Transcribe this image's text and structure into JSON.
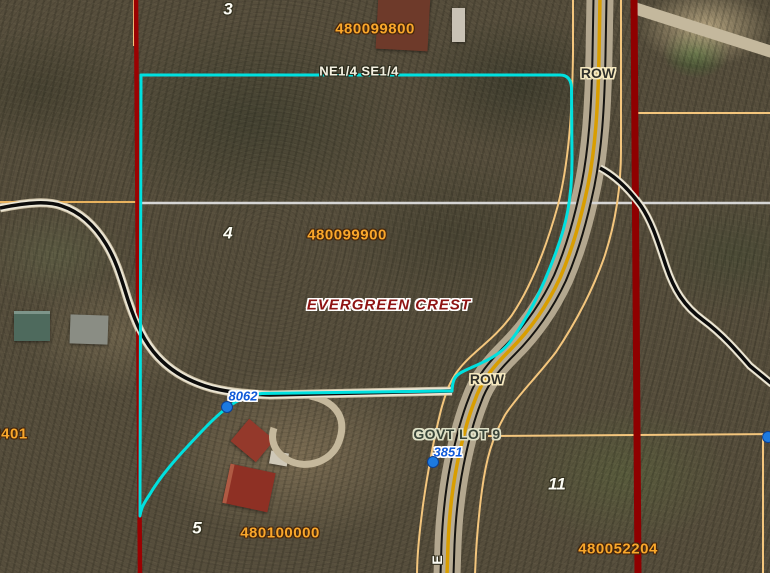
{
  "map": {
    "labels": {
      "section_3": "3",
      "parcel_480099800": "480099800",
      "aliquot_ne_se": "NE1/4 SE1/4",
      "row_upper": "ROW",
      "section_4": "4",
      "parcel_480099900": "480099900",
      "subdivision": "EVERGREEN CREST",
      "address_8062": "8062",
      "row_lower": "ROW",
      "govt_lot": "GOVT LOT 9",
      "address_3851": "3851",
      "section_11": "11",
      "parcel_480052204": "480052204",
      "parcel_480100000": "480100000",
      "section_5": "5",
      "parcel_2401": "2401",
      "road_name_partial": "E"
    },
    "colors": {
      "selection_cyan": "#00e0df",
      "boundary_dark_red": "#9b0202",
      "parcel_line_tan": "#f4c67d",
      "road_centerline_gold": "#d99e00",
      "section_line_gray": "#d6d6d6",
      "parcel_number_orange": "#f9a72b",
      "address_point_blue": "#1c7ae0",
      "subdivision_text_red": "#8e1313",
      "trail_black": "#0c0c0c"
    }
  }
}
